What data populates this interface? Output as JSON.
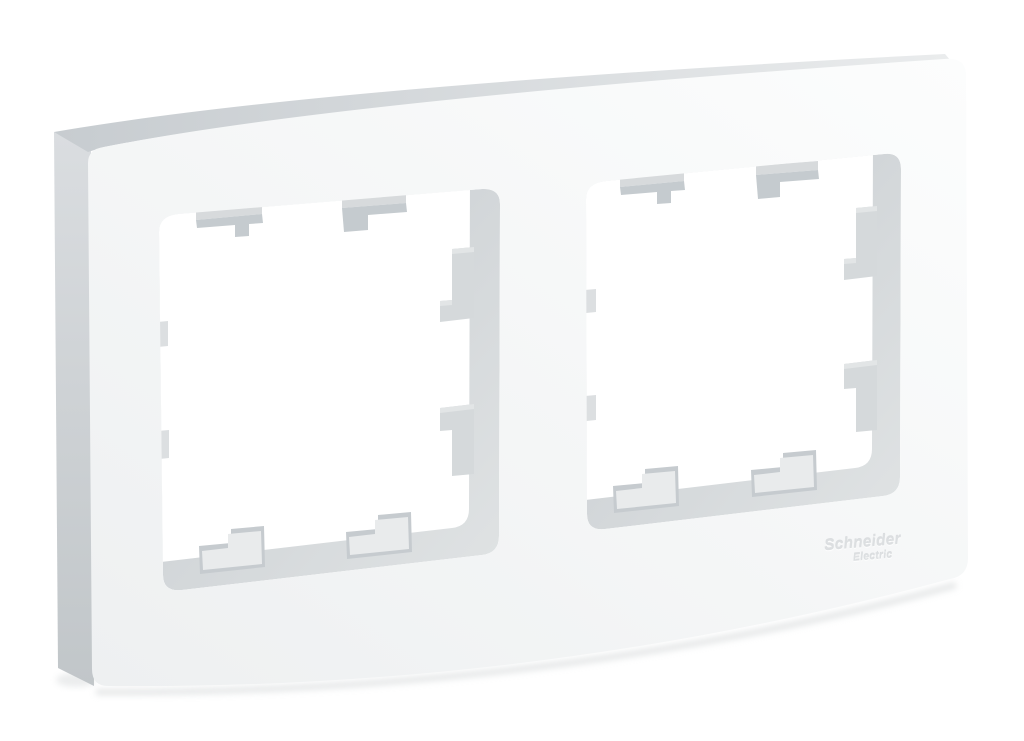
{
  "brand": {
    "line1": "Schneider",
    "line2": "Electric"
  },
  "colors": {
    "background": "#ffffff",
    "shadow": "#ced1d3",
    "front_light": "#fcfdfd",
    "front_dark": "#eef0f1",
    "side_top": "#dadde0",
    "side_bottom": "#c1c6c9",
    "bevel_left": "#c7ccd0",
    "bevel_right": "#eaeced",
    "wall_dark": "#c6cbcf",
    "wall_light": "#e0e3e4",
    "interior": "#ffffff",
    "clip_top_strip": "#d7dadc",
    "clip_front": "#c5cbcf",
    "clip_side": "#d5d9db",
    "clip_side_strip": "#e2e5e6",
    "clip_rim": "#c6cbcf",
    "clip_face": "#e9ebec",
    "nub": "#dcdfe1",
    "logo": "#dcdfe1"
  }
}
